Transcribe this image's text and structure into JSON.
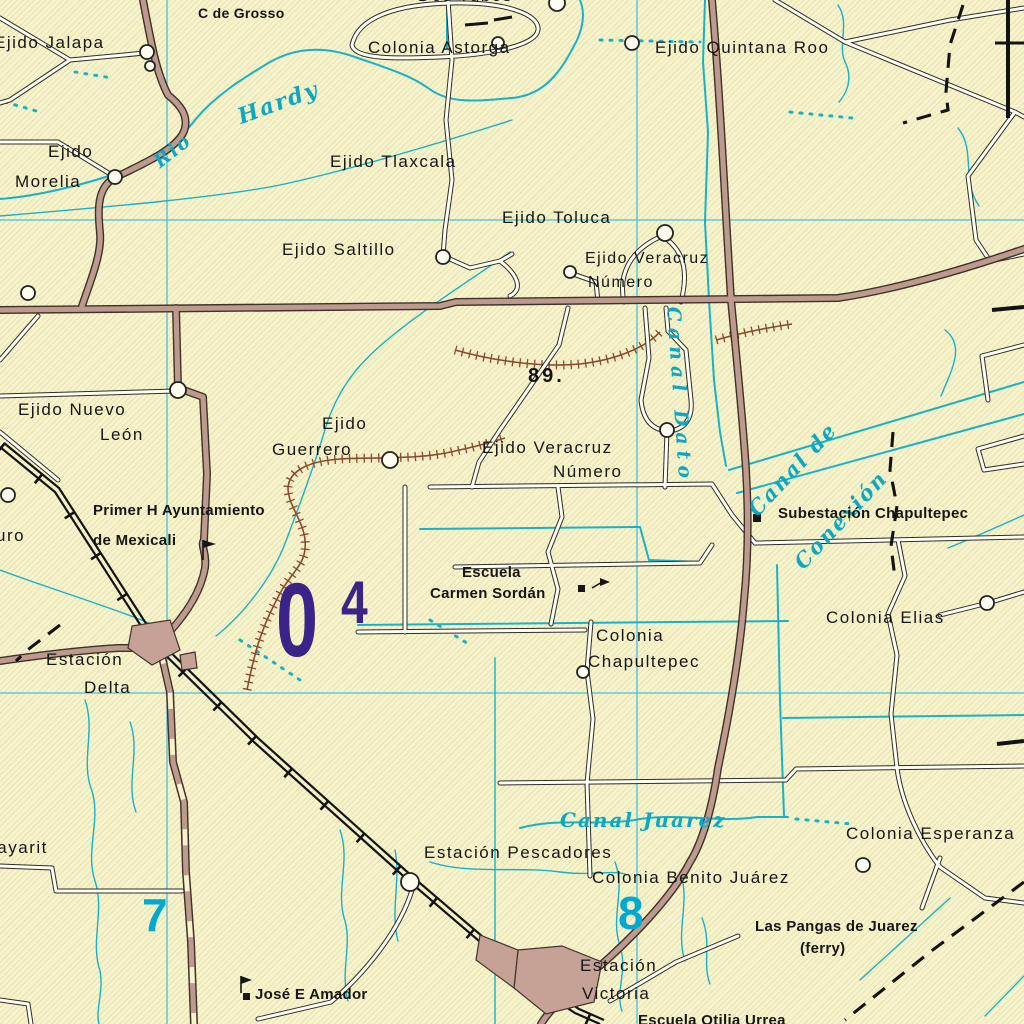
{
  "map_type": "topographic-map-mexicali-delta-region",
  "colors": {
    "background": "#f7f4cd",
    "water": "#17b2c8",
    "grid_line": "#45c1da",
    "major_road_fill": "#bd9a8e",
    "minor_road_fill": "#fffef4",
    "levee": "#8a4a2e",
    "grid_zone_purple": "#3b2488",
    "grid_number_cyan": "#00a9cf",
    "ink": "#161616"
  },
  "labels": {
    "c_de_grosso": "C de Grosso",
    "dos_tubos": "Dos Tubos",
    "ejido_jalapa": "Ejido Jalapa",
    "colonia_astorga": "Colonia Astorga",
    "ejido_quintana_roo": "Ejido Quintana Roo",
    "ejido_morelia_1": "Ejido",
    "ejido_morelia_2": "Morelia",
    "ejido_tlaxcala": "Ejido Tlaxcala",
    "ejido_toluca": "Ejido Toluca",
    "ejido_saltillo": "Ejido Saltillo",
    "ejido_veracruz_1a": "Ejido Veracruz",
    "ejido_veracruz_1b": "Número",
    "ejido_nuevo_leon_1": "Ejido Nuevo",
    "ejido_nuevo_leon_2": "León",
    "ejido_guerrero_1": "Ejido",
    "ejido_guerrero_2": "Guerrero",
    "ejido_veracruz_2a": "Ejido Veracruz",
    "ejido_veracruz_2b": "Número",
    "primer_h_1": "Primer H Ayuntamiento",
    "primer_h_2": "de Mexicali",
    "edge_fragment_uro": "uro",
    "escuela_carmen_1": "Escuela",
    "escuela_carmen_2": "Carmen Sordán",
    "subestacion_chapultepec": "Subestación Chapultepec",
    "colonia_elias": "Colonia Elias",
    "colonia_chapultepec_1": "Colonia",
    "colonia_chapultepec_2": "Chapultepec",
    "estacion_delta_1": "Estación",
    "estacion_delta_2": "Delta",
    "colonia_esperanza": "Colonia Esperanza",
    "estacion_pescadores": "Estación Pescadores",
    "colonia_benito_juarez": "Colonia Benito Juárez",
    "ejido_nayarit": "Ejido Nayarit",
    "las_pangas_1": "Las Pangas de Juarez",
    "las_pangas_2": "(ferry)",
    "estacion_victoria_1": "Estación",
    "estacion_victoria_2": "Victoria",
    "jose_e_amador": "José E Amador",
    "escuela_otilia_urrea": "Escuela Otilia Urrea"
  },
  "water_labels": {
    "rio": "Rio",
    "hardy": "Hardy",
    "canal_dato": "Canal Dato",
    "canal_de": "Canal de",
    "conexion": "Conexión",
    "canal_juarez": "Canal  Juarez"
  },
  "grid": {
    "zone_digit_main": "0",
    "zone_digit_sup": "4",
    "easting_7": "7",
    "easting_8": "8"
  },
  "spot_elevation": "89.",
  "symbols": [
    "locality-circle",
    "building-square",
    "flag",
    "built-up-area",
    "railroad",
    "levee-hatched",
    "boundary-dashed",
    "canal",
    "stream-intermittent"
  ]
}
